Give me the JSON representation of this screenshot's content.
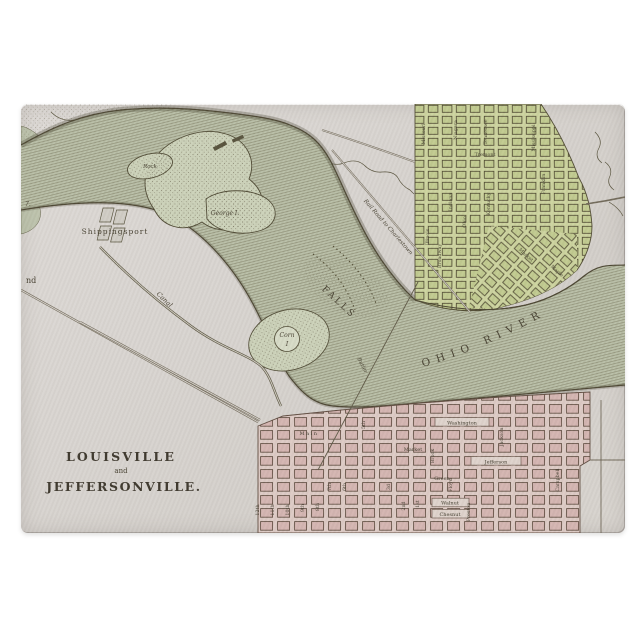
{
  "map": {
    "title": {
      "line1": "LOUISVILLE",
      "conjunction": "and",
      "line2": "JEFFERSONVILLE."
    },
    "water": {
      "river_name": "OHIO RIVER",
      "falls_label": "FALLS",
      "canal_label": "Canal"
    },
    "places": {
      "shippingsport": "Shippingsport",
      "corn_island_line1": "Corn",
      "corn_island_line2": "I",
      "george_island": "George I.",
      "rock_island": "Rock",
      "partial_word": "nd",
      "partial_number": "7."
    },
    "routes": {
      "railroad": "Rail Road to Charlestown",
      "ferry": "Butler"
    },
    "jeffersonville": {
      "streets": [
        "Missouri",
        "Niagara",
        "Tennessee",
        "Mississippi",
        "Tremont",
        "Franklin",
        "Indiana",
        "Kentucky",
        "Ohio",
        "Illinois",
        "Broadway",
        "Market",
        "Maple"
      ]
    },
    "louisville": {
      "streets_east_west": [
        "Washington",
        "Main",
        "Market",
        "Jefferson",
        "Green",
        "Walnut",
        "Chesnut"
      ],
      "streets_north_south": [
        "Brook",
        "Floyd",
        "Preston",
        "Jackson",
        "Campbell"
      ],
      "streets_numbered": [
        "12th",
        "11th",
        "10th",
        "9th",
        "8th",
        "7th",
        "6th",
        "5th",
        "3d",
        "2nd",
        "1st"
      ]
    },
    "colors": {
      "background": "#ffffff",
      "board_surface": "#d8d4cf",
      "river_water": "#b8bea6",
      "jeffersonville_grid": "#ccd39e",
      "louisville_grid": "#dccac4",
      "map_ink": "#4a4431"
    }
  }
}
